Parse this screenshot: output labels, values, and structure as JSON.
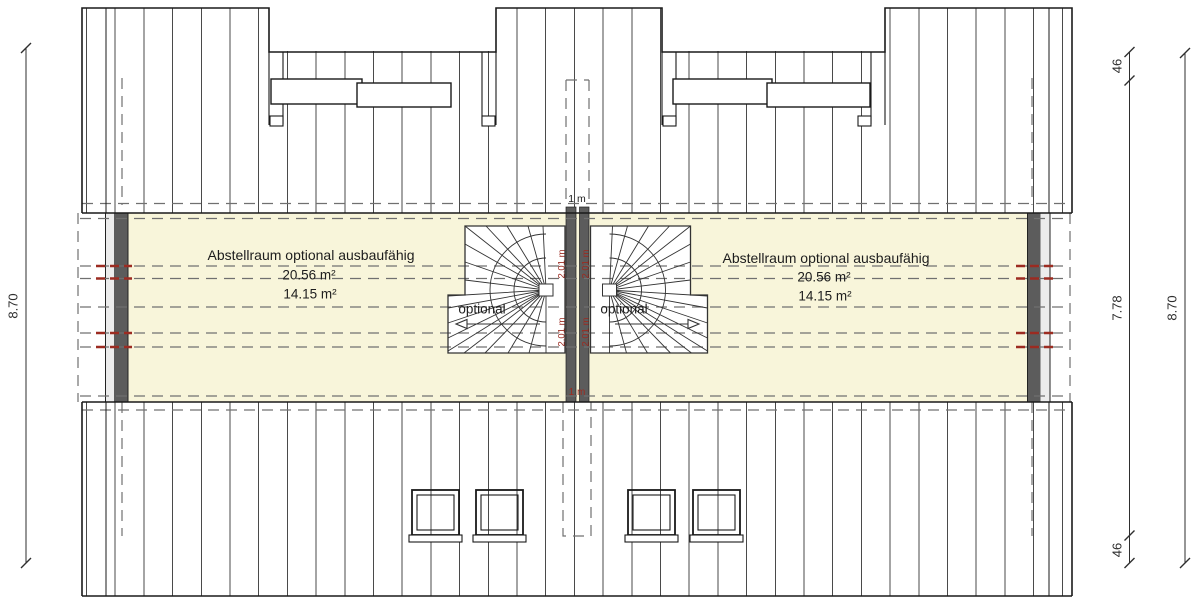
{
  "plan": {
    "left_room": {
      "title": "Abstellraum optional ausbaufähig",
      "area_gross": "20.56 m²",
      "area_net": "14.15 m²"
    },
    "right_room": {
      "title": "Abstellraum optional ausbaufähig",
      "area_gross": "20.56 m²",
      "area_net": "14.15 m²"
    },
    "labels": {
      "optional_left": "optional",
      "optional_right": "optional",
      "one_meter_line": "1 m",
      "headroom": "2.01 m"
    },
    "dimensions": {
      "left_total": "8.70",
      "right_upper_offset": "46",
      "right_inner": "7.78",
      "right_lower_offset": "46",
      "right_total": "8.70"
    },
    "colors": {
      "floor": "#f8f5da",
      "wall": "#5c5c5c",
      "marker_red": "#9c2b21"
    }
  }
}
